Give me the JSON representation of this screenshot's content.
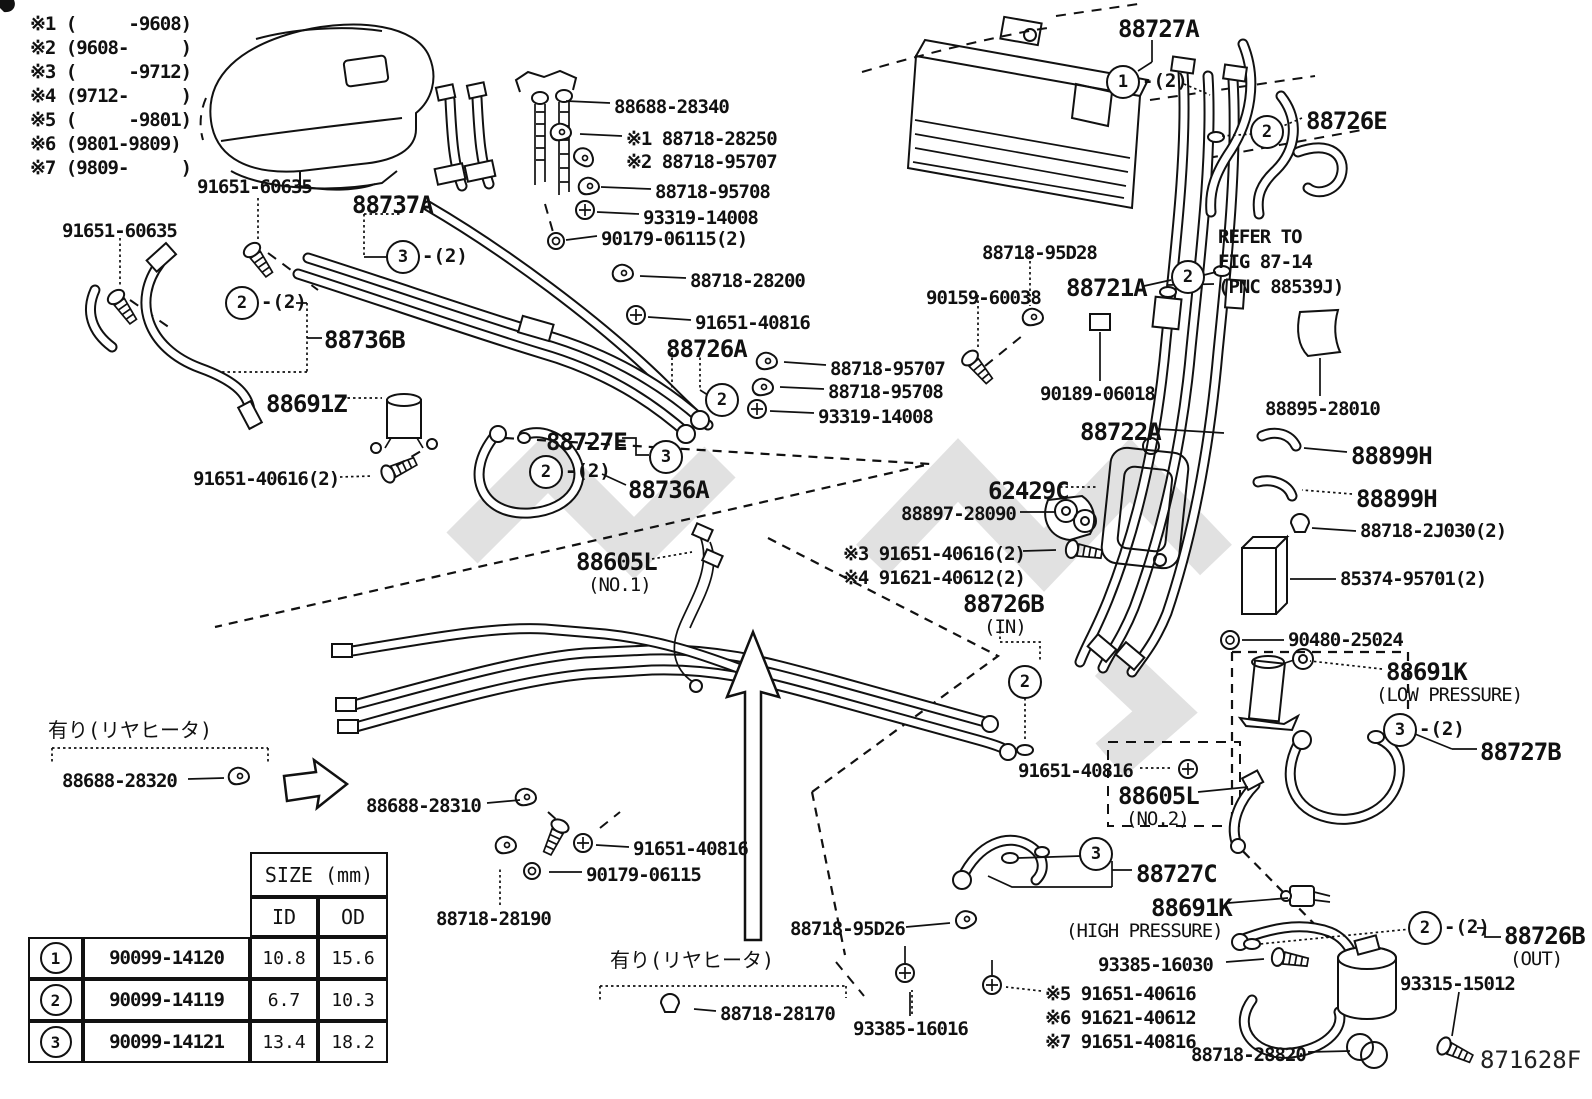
{
  "page": {
    "background": "#ffffff",
    "line_color": "#111111",
    "watermark_color": "#c8c8c8",
    "diagram_code": "871628F"
  },
  "notes": [
    "※1 (     -9608)",
    "※2 (9608-     )",
    "※3 (     -9712)",
    "※4 (9712-     )",
    "※5 (     -9801)",
    "※6 (9801-9809)",
    "※7 (9809-     )"
  ],
  "size_table": {
    "title": "SIZE (mm)",
    "col_id": "ID",
    "col_od": "OD",
    "rows": [
      {
        "num": "1",
        "part": "90099-14120",
        "id": "10.8",
        "od": "15.6"
      },
      {
        "num": "2",
        "part": "90099-14119",
        "id": "6.7",
        "od": "10.3"
      },
      {
        "num": "3",
        "part": "90099-14121",
        "id": "13.4",
        "od": "18.2"
      }
    ]
  },
  "diagram": {
    "labels": [
      {
        "id": "88688-28340",
        "text": "88688-28340",
        "x": 614,
        "y": 96,
        "cls": "std"
      },
      {
        "id": "88718-28250",
        "text": "※1 88718-28250",
        "x": 626,
        "y": 128,
        "cls": "std"
      },
      {
        "id": "88718-95707-a",
        "text": "※2 88718-95707",
        "x": 626,
        "y": 151,
        "cls": "std"
      },
      {
        "id": "88718-95708-a",
        "text": "88718-95708",
        "x": 655,
        "y": 181,
        "cls": "std"
      },
      {
        "id": "93319-14008-a",
        "text": "93319-14008",
        "x": 643,
        "y": 207,
        "cls": "std"
      },
      {
        "id": "90179-06115-2",
        "text": "90179-06115(2)",
        "x": 601,
        "y": 228,
        "cls": "std"
      },
      {
        "id": "91651-60635-a",
        "text": "91651-60635",
        "x": 197,
        "y": 176,
        "cls": "std"
      },
      {
        "id": "88737A",
        "text": "88737A",
        "x": 352,
        "y": 191,
        "cls": "big"
      },
      {
        "id": "91651-60635-b",
        "text": "91651-60635",
        "x": 62,
        "y": 220,
        "cls": "std"
      },
      {
        "id": "88727A",
        "text": "88727A",
        "x": 1118,
        "y": 15,
        "cls": "big"
      },
      {
        "id": "88726E",
        "text": "88726E",
        "x": 1306,
        "y": 107,
        "cls": "big"
      },
      {
        "id": "refer-line1",
        "text": "REFER TO",
        "x": 1218,
        "y": 226,
        "cls": "std",
        "it": false
      },
      {
        "id": "refer-line2",
        "text": "FIG 87-14",
        "x": 1218,
        "y": 251,
        "cls": "std",
        "it": false
      },
      {
        "id": "refer-line3",
        "text": "(PNC 88539J)",
        "x": 1218,
        "y": 276,
        "cls": "std",
        "it": false
      },
      {
        "id": "88718-95D28",
        "text": "88718-95D28",
        "x": 982,
        "y": 242,
        "cls": "std"
      },
      {
        "id": "88721A",
        "text": "88721A",
        "x": 1066,
        "y": 274,
        "cls": "big"
      },
      {
        "id": "90159-60038",
        "text": "90159-60038",
        "x": 926,
        "y": 287,
        "cls": "std"
      },
      {
        "id": "88718-28200",
        "text": "88718-28200",
        "x": 690,
        "y": 270,
        "cls": "std"
      },
      {
        "id": "91651-40816-a",
        "text": "91651-40816",
        "x": 695,
        "y": 312,
        "cls": "std"
      },
      {
        "id": "88736B",
        "text": "88736B",
        "x": 324,
        "y": 326,
        "cls": "big"
      },
      {
        "id": "88726A",
        "text": "88726A",
        "x": 666,
        "y": 335,
        "cls": "big"
      },
      {
        "id": "88718-95707-b",
        "text": "88718-95707",
        "x": 830,
        "y": 358,
        "cls": "std"
      },
      {
        "id": "88718-95708-b",
        "text": "88718-95708",
        "x": 828,
        "y": 381,
        "cls": "std"
      },
      {
        "id": "93319-14008-b",
        "text": "93319-14008",
        "x": 818,
        "y": 406,
        "cls": "std"
      },
      {
        "id": "90189-06018",
        "text": "90189-06018",
        "x": 1040,
        "y": 383,
        "cls": "std"
      },
      {
        "id": "88691Z",
        "text": "88691Z",
        "x": 266,
        "y": 390,
        "cls": "big"
      },
      {
        "id": "88727E",
        "text": "88727E",
        "x": 546,
        "y": 428,
        "cls": "big"
      },
      {
        "id": "88722A",
        "text": "88722A",
        "x": 1080,
        "y": 418,
        "cls": "big"
      },
      {
        "id": "88895-28010",
        "text": "88895-28010",
        "x": 1265,
        "y": 398,
        "cls": "std"
      },
      {
        "id": "88899H-a",
        "text": "88899H",
        "x": 1351,
        "y": 442,
        "cls": "big"
      },
      {
        "id": "88899H-b",
        "text": "88899H",
        "x": 1356,
        "y": 485,
        "cls": "big"
      },
      {
        "id": "91651-40616-2",
        "text": "91651-40616(2)",
        "x": 193,
        "y": 468,
        "cls": "std"
      },
      {
        "id": "88736A",
        "text": "88736A",
        "x": 628,
        "y": 476,
        "cls": "big"
      },
      {
        "id": "62429C",
        "text": "62429C",
        "x": 988,
        "y": 477,
        "cls": "big"
      },
      {
        "id": "88897-28090",
        "text": "88897-28090",
        "x": 901,
        "y": 503,
        "cls": "std"
      },
      {
        "id": "88718-2J030-2",
        "text": "88718-2J030(2)",
        "x": 1360,
        "y": 520,
        "cls": "std"
      },
      {
        "id": "n3-91651-40616-2",
        "text": "※3 91651-40616(2)",
        "x": 843,
        "y": 543,
        "cls": "std"
      },
      {
        "id": "n4-91621-40612-2",
        "text": "※4 91621-40612(2)",
        "x": 843,
        "y": 567,
        "cls": "std"
      },
      {
        "id": "88605L-no1",
        "text": "88605L",
        "x": 576,
        "y": 548,
        "cls": "big"
      },
      {
        "id": "88605L-no1-sub",
        "text": "(NO.1)",
        "x": 588,
        "y": 574,
        "cls": "sub",
        "it": false
      },
      {
        "id": "85374-95701-2",
        "text": "85374-95701(2)",
        "x": 1340,
        "y": 568,
        "cls": "std"
      },
      {
        "id": "88726B-in",
        "text": "88726B",
        "x": 963,
        "y": 590,
        "cls": "big"
      },
      {
        "id": "88726B-in-sub",
        "text": "(IN)",
        "x": 984,
        "y": 616,
        "cls": "sub",
        "it": false
      },
      {
        "id": "90480-25024",
        "text": "90480-25024",
        "x": 1288,
        "y": 629,
        "cls": "std"
      },
      {
        "id": "88691K-low",
        "text": "88691K",
        "x": 1386,
        "y": 658,
        "cls": "big"
      },
      {
        "id": "88691K-low-sub",
        "text": "(LOW PRESSURE)",
        "x": 1376,
        "y": 684,
        "cls": "sub",
        "it": false
      },
      {
        "id": "jp-rear-heater-1",
        "text": "有り(リヤヒータ)",
        "x": 48,
        "y": 714,
        "cls": "jp",
        "it": false
      },
      {
        "id": "88727B",
        "text": "88727B",
        "x": 1480,
        "y": 738,
        "cls": "big"
      },
      {
        "id": "88688-28320",
        "text": "88688-28320",
        "x": 62,
        "y": 770,
        "cls": "std"
      },
      {
        "id": "88688-28310",
        "text": "88688-28310",
        "x": 366,
        "y": 795,
        "cls": "std"
      },
      {
        "id": "91651-40816-b",
        "text": "91651-40816",
        "x": 1018,
        "y": 760,
        "cls": "std"
      },
      {
        "id": "88605L-no2",
        "text": "88605L",
        "x": 1118,
        "y": 782,
        "cls": "big"
      },
      {
        "id": "88605L-no2-sub",
        "text": "(NO.2)",
        "x": 1126,
        "y": 808,
        "cls": "sub",
        "it": false
      },
      {
        "id": "91651-40816-c",
        "text": "91651-40816",
        "x": 633,
        "y": 838,
        "cls": "std"
      },
      {
        "id": "90179-06115",
        "text": "90179-06115",
        "x": 586,
        "y": 864,
        "cls": "std"
      },
      {
        "id": "88727C",
        "text": "88727C",
        "x": 1136,
        "y": 860,
        "cls": "big"
      },
      {
        "id": "88718-28190",
        "text": "88718-28190",
        "x": 436,
        "y": 908,
        "cls": "std"
      },
      {
        "id": "88691K-high",
        "text": "88691K",
        "x": 1151,
        "y": 894,
        "cls": "big"
      },
      {
        "id": "88691K-high-sub",
        "text": "(HIGH PRESSURE)",
        "x": 1066,
        "y": 920,
        "cls": "sub",
        "it": false
      },
      {
        "id": "88718-95D26",
        "text": "88718-95D26",
        "x": 790,
        "y": 918,
        "cls": "std"
      },
      {
        "id": "88726B-out",
        "text": "88726B",
        "x": 1504,
        "y": 922,
        "cls": "big"
      },
      {
        "id": "88726B-out-sub",
        "text": "(OUT)",
        "x": 1510,
        "y": 948,
        "cls": "sub",
        "it": false
      },
      {
        "id": "93385-16030",
        "text": "93385-16030",
        "x": 1098,
        "y": 954,
        "cls": "std"
      },
      {
        "id": "jp-rear-heater-2",
        "text": "有り(リヤヒータ)",
        "x": 610,
        "y": 944,
        "cls": "jp",
        "it": false
      },
      {
        "id": "93315-15012",
        "text": "93315-15012",
        "x": 1400,
        "y": 973,
        "cls": "std"
      },
      {
        "id": "n5-91651-40616",
        "text": "※5 91651-40616",
        "x": 1045,
        "y": 983,
        "cls": "std"
      },
      {
        "id": "n6-91621-40612",
        "text": "※6 91621-40612",
        "x": 1045,
        "y": 1007,
        "cls": "std"
      },
      {
        "id": "n7-91651-40816",
        "text": "※7 91651-40816",
        "x": 1045,
        "y": 1031,
        "cls": "std"
      },
      {
        "id": "88718-28170",
        "text": "88718-28170",
        "x": 720,
        "y": 1003,
        "cls": "std"
      },
      {
        "id": "93385-16016",
        "text": "93385-16016",
        "x": 853,
        "y": 1018,
        "cls": "std"
      },
      {
        "id": "88718-28820",
        "text": "88718-28820",
        "x": 1191,
        "y": 1044,
        "cls": "std"
      },
      {
        "id": "fig-code",
        "text": "871628F",
        "x": 1480,
        "y": 1046,
        "cls": "code",
        "it": false
      }
    ],
    "callouts": [
      {
        "n": "1",
        "x": 1123,
        "y": 82,
        "suffix": "-(2)"
      },
      {
        "n": "2",
        "x": 1267,
        "y": 132
      },
      {
        "n": "3",
        "x": 403,
        "y": 257,
        "suffix": "-(2)"
      },
      {
        "n": "2",
        "x": 242,
        "y": 303,
        "suffix": "-(2)"
      },
      {
        "n": "2",
        "x": 1188,
        "y": 277
      },
      {
        "n": "2",
        "x": 722,
        "y": 400
      },
      {
        "n": "3",
        "x": 666,
        "y": 457
      },
      {
        "n": "2",
        "x": 546,
        "y": 472,
        "suffix": "-(2)"
      },
      {
        "n": "2",
        "x": 1025,
        "y": 682
      },
      {
        "n": "3",
        "x": 1400,
        "y": 730,
        "suffix": "-(2)"
      },
      {
        "n": "3",
        "x": 1096,
        "y": 854
      },
      {
        "n": "2",
        "x": 1425,
        "y": 928,
        "suffix": "-(2)"
      }
    ]
  }
}
